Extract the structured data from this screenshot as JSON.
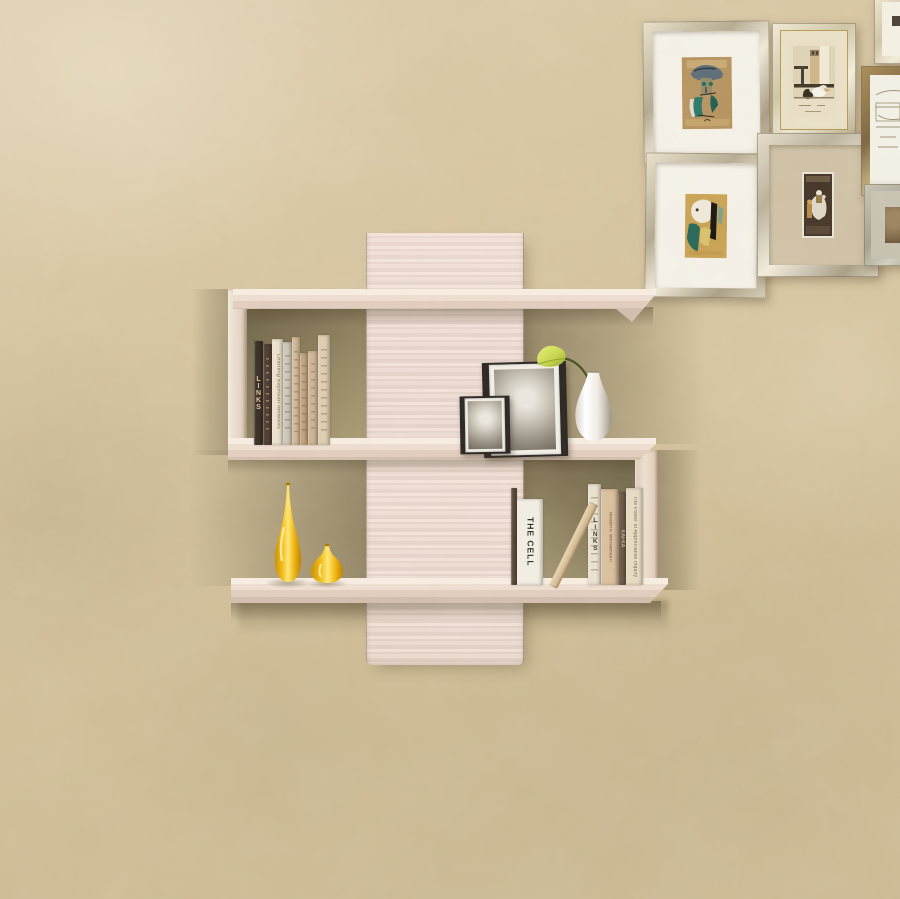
{
  "scene": {
    "type": "photograph",
    "description": "Cross-shaped pale-wood wall shelf with books, two black photo frames, a white vase holding a green calla lily and two glossy yellow vases, mounted on a textured beige plaster wall; a gallery of small framed artworks hangs in the upper-right corner",
    "colors": {
      "wall": "#d3c19e",
      "shelf_wood": "#ecddd2",
      "cubby_shadow": "#7c7053",
      "vase_yellow": "#f2b719",
      "photo_frame_black": "#2b2622",
      "flower_green": "#b9c84a",
      "white_vase": "#f3efe9"
    }
  },
  "gallery": {
    "frames": [
      {
        "name": "cubist-portrait-framed-art"
      },
      {
        "name": "pelican-print-framed-art"
      },
      {
        "name": "abstract-face-framed-art"
      },
      {
        "name": "horse-rider-miniature-framed-art"
      },
      {
        "name": "corner-partial-frame"
      },
      {
        "name": "pencil-sketch-partial-frame"
      },
      {
        "name": "sepia-etching-partial-frame"
      }
    ]
  },
  "shelf": {
    "upper_books": [
      {
        "title": "LINKS"
      },
      {
        "title": ""
      },
      {
        "title": "Learning Bayesian Networks"
      },
      {
        "title": ""
      },
      {
        "title": ""
      },
      {
        "title": ""
      },
      {
        "title": ""
      },
      {
        "title": ""
      }
    ],
    "lower_books": [
      {
        "title": ""
      },
      {
        "title": "THE CELL"
      },
      {
        "title": ""
      },
      {
        "title": "LINKS"
      },
      {
        "title": "Modern Mendelism"
      },
      {
        "title": "KAFKA"
      },
      {
        "title": "The Power of Appreciative Inquiry"
      }
    ],
    "decor": {
      "large_photo": "baby-portrait-black-frame",
      "small_photo": "baby-portrait-small-black-frame",
      "flower_vase": "white-vase-with-calla-lily",
      "tall_vase": "tall-yellow-teardrop-vase",
      "small_vase": "small-yellow-bud-vase"
    }
  }
}
